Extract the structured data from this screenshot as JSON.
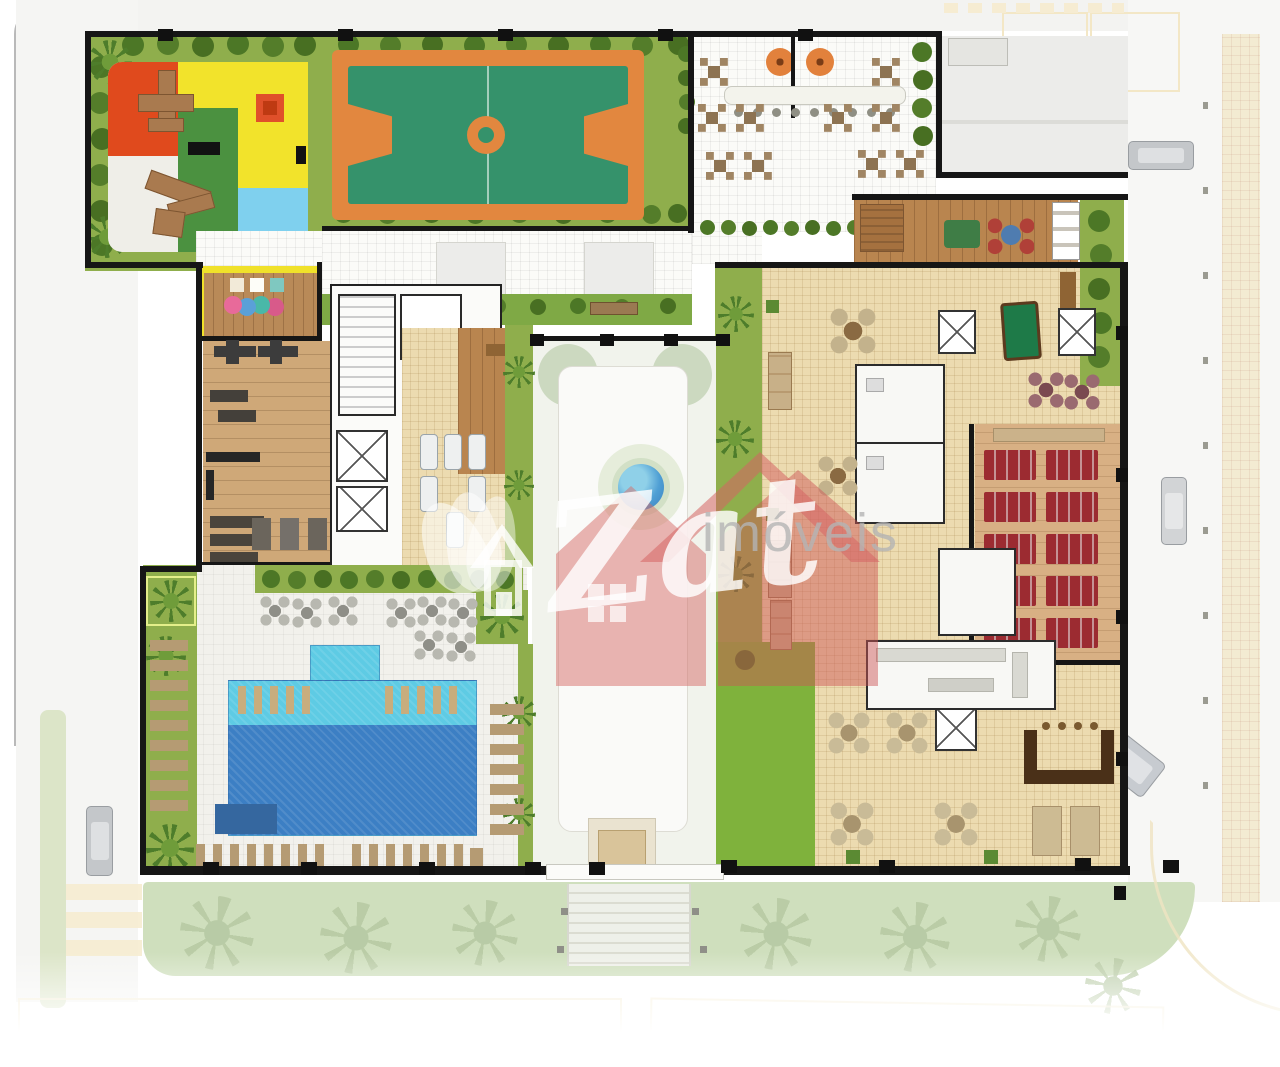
{
  "watermark": {
    "script": "Zat",
    "suffix": "imóveis"
  },
  "palette": {
    "grass": "#8fae4c",
    "lawn": "#7fb23c",
    "court_orange": "#e2873f",
    "court_green": "#35926b",
    "playground_red": "#e04a1d",
    "playground_yellow": "#f2e32b",
    "playground_green": "#4b9140",
    "playground_blue": "#7fd0ee",
    "pool_light": "#5ecbe4",
    "pool_dark": "#3c7fc4",
    "spa_pool_blue": "#4ab8e8",
    "tile_beige": "#ecdbb0",
    "deck_wood": "#b9854f",
    "gym_wood": "#cfa878",
    "cinema_seat_red": "#9c2b31",
    "bar_brown": "#4a3018",
    "wall_black": "#161616",
    "street_gray": "#f4f4f2",
    "sidewalk_cream": "#f3ebd2",
    "faded_strip_green": "#cfdfbd",
    "watermark_red": "rgba(205,85,85,0.5)"
  },
  "regions": [
    {
      "id": "kids-playground",
      "color": "#f2e32b"
    },
    {
      "id": "sports-court",
      "color": "#35926b"
    },
    {
      "id": "pergola-walkway",
      "color": "#f4f4f0"
    },
    {
      "id": "bbq-terrace",
      "color": "#fbfbf8"
    },
    {
      "id": "entrance-driveway",
      "color": "#ececea"
    },
    {
      "id": "spa-sun-deck",
      "color": "#b9854f"
    },
    {
      "id": "games-room",
      "color": "#ecdbb0"
    },
    {
      "id": "lounge-hall",
      "color": "#ecdbb0"
    },
    {
      "id": "cinema-room",
      "color": "#9c2b31"
    },
    {
      "id": "kitchen",
      "color": "#f8f8f5"
    },
    {
      "id": "party-hall",
      "color": "#ecdbb0"
    },
    {
      "id": "bar-counter",
      "color": "#4a3018"
    },
    {
      "id": "central-courtyard",
      "color": "#f1f3ec"
    },
    {
      "id": "kids-playroom",
      "color": "#b98a58"
    },
    {
      "id": "gym",
      "color": "#cfa878"
    },
    {
      "id": "stair-elevator-core",
      "color": "#fbfbf9"
    },
    {
      "id": "reading-deck",
      "color": "#b9854f"
    },
    {
      "id": "swimming-pool",
      "color": "#3c7fc4"
    },
    {
      "id": "pool-deck",
      "color": "#f2f1ec"
    },
    {
      "id": "perimeter-streets",
      "color": "#f4f4f2"
    }
  ],
  "features": {
    "cinema_seat_rows": 5,
    "cinema_seat_columns": 2,
    "bbq_grills": 2,
    "elevator_shafts": 6,
    "parked_cars": 4,
    "pools": 2
  }
}
